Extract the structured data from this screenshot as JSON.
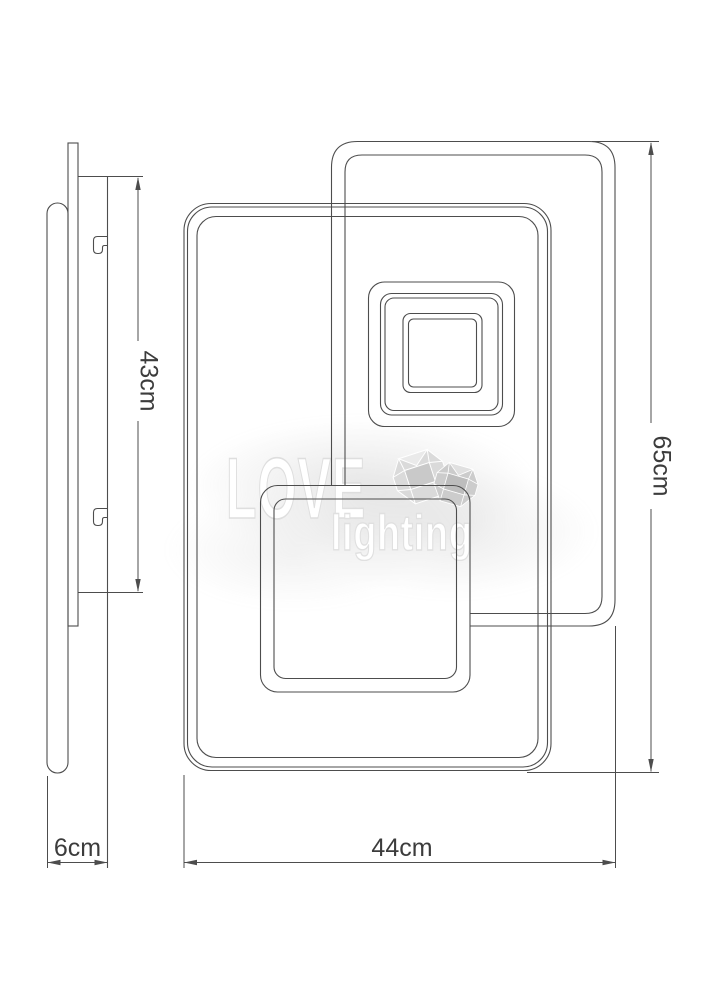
{
  "dimensions": {
    "bracket_height": "43cm",
    "fixture_depth": "6cm",
    "total_height": "65cm",
    "total_width": "44cm"
  },
  "watermark": {
    "brand_line1": "LOVE",
    "brand_line2": "lighting"
  },
  "colors": {
    "line": "#4d4d4d",
    "dimension_text": "#3c3c3c",
    "watermark_gray": "#dedede",
    "background": "#ffffff"
  }
}
